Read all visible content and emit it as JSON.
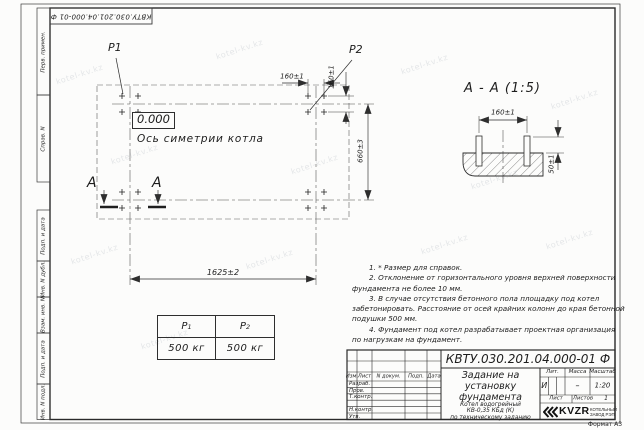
{
  "watermark": {
    "text": "kotel-kv.kz"
  },
  "sheet": {
    "top_reference": "КВТУ.030.201.04.000-01 Ф",
    "format_note": "Формат А3",
    "side_fields": [
      "Перв. примен.",
      "Справ. N",
      "Подп. и дата",
      "Инв. N дубл.",
      "Взам. инв. N",
      "Подп. и дата",
      "Инв. N подл."
    ]
  },
  "plan": {
    "load_point_1": "P1",
    "load_point_2": "P2",
    "level_mark": "0.000",
    "axis_caption": "Ось симетрии котла",
    "dim_bolt_spacing_h": "160±1",
    "dim_bolt_spacing_v": "160±1",
    "dim_length": "1625±2",
    "dim_width": "660±3",
    "section_mark_left": "А",
    "section_mark_right": "А"
  },
  "section_view": {
    "title": "А - А (1:5)",
    "dim_bolt_spacing": "160±1",
    "dim_bolt_height": "50±1"
  },
  "loads_table": {
    "col1": {
      "base": "P",
      "sub": "1",
      "value": "500 кг"
    },
    "col2": {
      "base": "P",
      "sub": "2",
      "value": "500 кг"
    }
  },
  "notes": {
    "lines": [
      "1. * Размер для справок.",
      "2. Отклонение от горизонтального уровня верхней поверхности",
      "фундамента не более 10 мм.",
      "3. В случае отсутствия бетонного пола площадку под котел",
      "забетонировать. Расстояние от осей крайних колонн до края бетонной",
      "подушки 500 мм.",
      "4. Фундамент под котел разрабатывает проектная организация",
      "по нагрузкам на фундамент."
    ]
  },
  "title_block": {
    "designation": "КВТУ.030.201.04.000-01 Ф",
    "doc_title_lines": [
      "Задание на",
      "установку",
      "фундамента"
    ],
    "product_lines": [
      "Котел водогрейный",
      "КВ-0,35 КБд (К)",
      "по техническому заданию"
    ],
    "header_cols": [
      "Изм.",
      "Лист",
      "N докум.",
      "Подп.",
      "Дата"
    ],
    "sign_rows": [
      "Разраб.",
      "Пров.",
      "Т.контр.",
      "Н.контр.",
      "Утв."
    ],
    "lit_header": "Лит.",
    "mass_header": "Масса",
    "scale_header": "Масштаб",
    "lit_value": "И",
    "mass_value": "–",
    "scale_value": "1:20",
    "sheet_label": "Лист",
    "sheets_label": "Листов",
    "sheets_value": "1",
    "logo_text": "KVZR",
    "logo_caption_lines": [
      "КОТЕЛЬНЫЙ",
      "ЗАВОД РЭП"
    ]
  }
}
